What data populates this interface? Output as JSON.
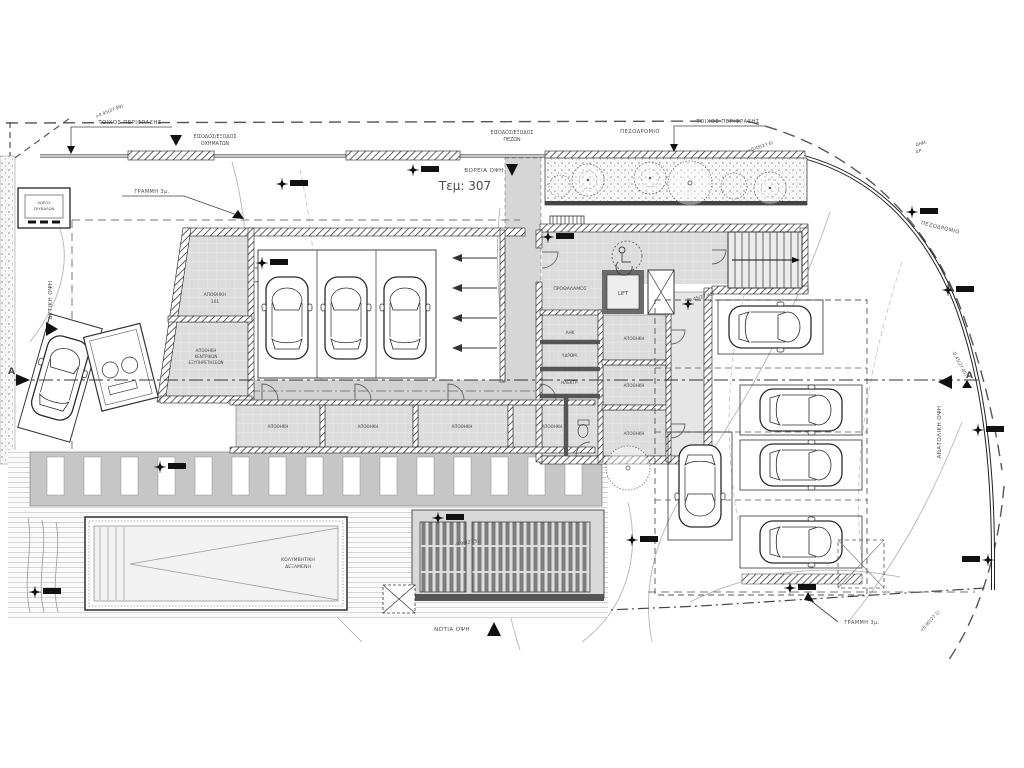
{
  "plot": {
    "number": "Τεμ: 307"
  },
  "site": {
    "fence_wall_left": "ΤΟΙΧΟΣ ΠΕΡΙΦΡΑΞΗΣ",
    "fence_wall_right": "ΤΟΙΧΟΣ ΠΕΡΙΦΡΑΞΗΣ",
    "vehicle_entry_l1": "ΕΙΣΟΔΟΣ/ΕΞΟΔΟΣ",
    "vehicle_entry_l2": "ΟΧΗΜΑΤΩΝ",
    "ped_entry_l1": "ΕΙΣΟΔΟΣ/ΕΞΟΔΟΣ",
    "ped_entry_l2": "ΠΕΖΩΝ",
    "sidewalk_top": "ΠΕΖΟΔΡΟΜΙΟ",
    "sidewalk_right": "ΠΕΖΟΔΡΟΜΙΟ",
    "setback_line_top": "ΓΡΑΜΜΗ 3μ.",
    "setback_line_bottom": "ΓΡΑΜΜΗ 3μ.",
    "public_road_l1": "ΔΗΜ.",
    "public_road_l2": "ΔΡ."
  },
  "elevations": {
    "north": "ΒΟΡΕΙΑ ΟΨΗ",
    "south": "ΝΟΤΙΑ ΟΨΗ",
    "west": "ΔΥΤΙΚΗ ΟΨΗ",
    "east": "ΑΝΑΤΟΛΙΚΗ ΟΨΗ"
  },
  "section": {
    "marker_left": "A",
    "marker_right": "A"
  },
  "building": {
    "lift": "LIFT",
    "lobby": "ΠΡΟΘΑΛΑΜΟΣ",
    "store101_l1": "ΑΠΟΘΗΚΗ",
    "store101_l2": "101",
    "store_central_l1": "ΑΠΟΘΗΚΗ",
    "store_central_l2": "ΚΕΝΤΡΙΚΩΝ",
    "store_central_l3": "ΕΞΥΠΗΡΕΤΗΣΕΩΝ",
    "room_ahk": "ΑΗΚ",
    "room_hydro": "ΥΔΡΟΜ.",
    "room_electrical": "ΗΛΕΚΤΡ.",
    "storage": "ΑΠΟΘΗΚΗ",
    "refuse_l1": "ΧΩΡΟΣ",
    "refuse_l2": "ΣΚΥΒΑΛΩΝ"
  },
  "outdoor": {
    "pool_l1": "ΚΟΛΥΜΒΗΤΙΚΗ",
    "pool_l2": "ΔΕΞΑΜΕΝΗ"
  },
  "levels": {
    "a": "+0.45(27.99)",
    "b": "-0.45(27.45)",
    "c": "-0.90(27.5)",
    "d": "+0.90(27.1)",
    "e": "+0.45(27.6)"
  }
}
